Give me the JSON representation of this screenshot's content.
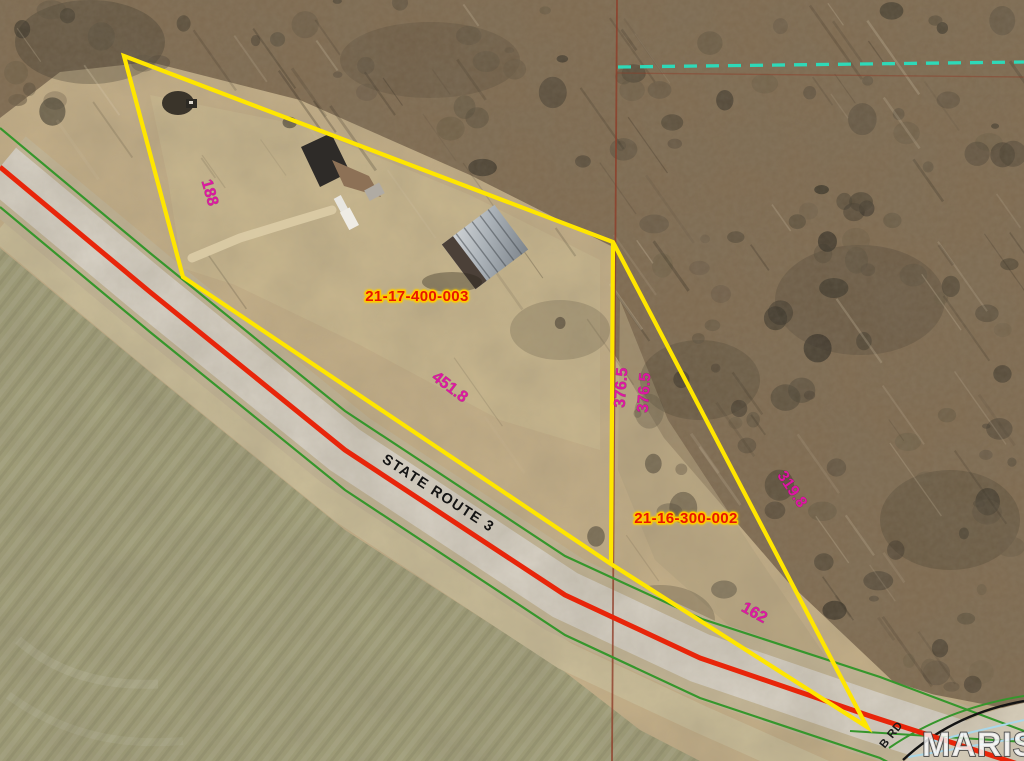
{
  "map": {
    "parcels": [
      {
        "id": "21-17-400-003",
        "dimensions": {
          "west_edge": "188",
          "south_edge": "451.8",
          "east_edge": "376.5"
        }
      },
      {
        "id": "21-16-300-002",
        "dimensions": {
          "west_edge": "376.5",
          "northeast_edge": "319.8",
          "south_edge": "162"
        }
      }
    ],
    "road_label": "STATE ROUTE 3",
    "side_road_label": "B RD",
    "watermark": "MARIS",
    "colors": {
      "parcel_boundary": "#ffe600",
      "dimension_text": "#dd17a2",
      "parcel_id_text": "#e81400",
      "parcel_id_halo": "#ffc800",
      "road_centerline": "#e8250a",
      "right_of_way_green": "#36962c",
      "section_line": "#8f3c28",
      "dashed_boundary_cyan": "#2ed9b8",
      "hydro_light_blue": "#a9d6e8"
    }
  }
}
